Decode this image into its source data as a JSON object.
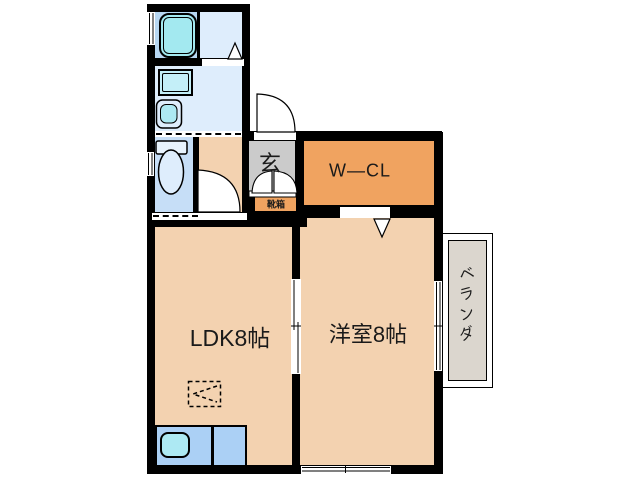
{
  "floorplan": {
    "rooms": {
      "entrance": {
        "label": "玄"
      },
      "walk_in_closet": {
        "label": "W—CL"
      },
      "ldk": {
        "label": "LDK8帖"
      },
      "western_room": {
        "label": "洋室8帖"
      },
      "veranda": {
        "label": "ベランダ"
      },
      "shoe_box": {
        "label": "靴箱"
      }
    },
    "fixtures": {
      "bathtub": "bathtub",
      "washing_machine_pan": "washing-machine-pan",
      "washbasin": "washbasin",
      "toilet": "toilet",
      "kitchen_counter": "kitchen-counter",
      "kitchen_sink": "kitchen-sink",
      "refrigerator_space": "refrigerator-space"
    },
    "colors": {
      "wall": "#000000",
      "room_peach": "#f3d2b0",
      "closet_orange": "#f0a360",
      "entrance_gray": "#cbcbcb",
      "washroom_blue": "#deedfc",
      "bathroom_blue": "#b7d7f2",
      "toilet_blue": "#c6def7",
      "fixture_cyan": "#a3e9f0",
      "counter_blue": "#abd0f5",
      "veranda_gray": "#dbd6ce"
    }
  }
}
